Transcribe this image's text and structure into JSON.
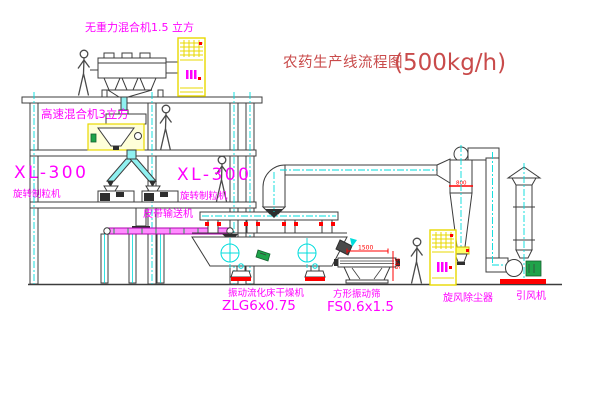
{
  "canvas": {
    "width": 600,
    "height": 403,
    "background": "#ffffff"
  },
  "title": {
    "name": "农药生产线流程图",
    "capacity": "(500kg/h)"
  },
  "labels": {
    "gravity_mixer": "无重力混合机1.5 立方",
    "high_speed_mixer": "高速混合机3立方",
    "granulator_left_model": "XL-300",
    "granulator_left_name": "旋转制粒机",
    "granulator_right_model": "XL-300",
    "granulator_right_name": "旋转制粒机",
    "belt_conveyor": "皮带输送机",
    "dryer_name": "振动流化床干燥机",
    "dryer_model": "ZLG6x0.75",
    "screen_name": "方形振动筛",
    "screen_model": "FS0.6x1.5",
    "cyclone": "旋风除尘器",
    "fan": "引风机"
  },
  "dimensions": {
    "screen_length": "1500",
    "screen_side": "545",
    "cyclone_band": "800"
  },
  "colors": {
    "linework": "#3c3c3c",
    "centerline_cyan": "#00dcdc",
    "label_magenta": "#ff00ff",
    "title_red": "#c94b4b",
    "dimension_red": "#ff0000",
    "cabinet_yellow": "#e8d900",
    "machine_green": "#1fa34a",
    "belt_pink": "#ff8cff"
  },
  "figures": {
    "workers_visible": 4,
    "control_cabinets_visible": 2
  }
}
